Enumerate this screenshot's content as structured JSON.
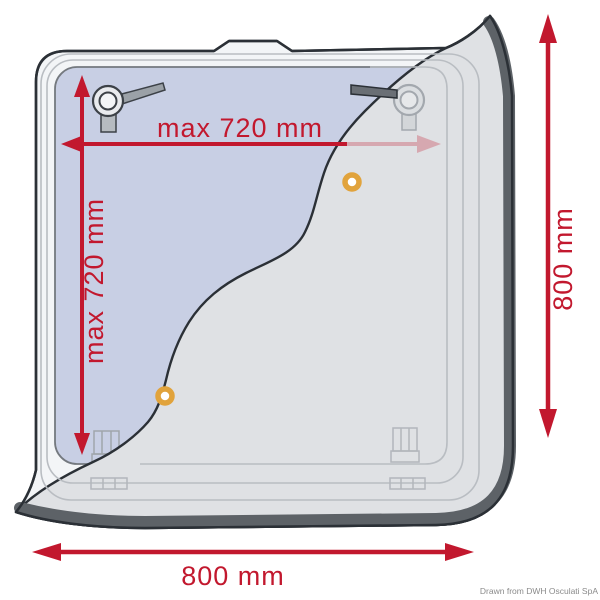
{
  "diagram": {
    "type": "technical-dimension-drawing",
    "subject": "deck hatch with roller shade, plan view with installation dimensions",
    "labels": {
      "opening_width": "max 720 mm",
      "opening_height": "max 720 mm",
      "overall_height": "800 mm",
      "overall_width": "800 mm"
    },
    "credit": "Drawn from DWH Osculati SpA",
    "colors": {
      "dimension_red": "#c2182e",
      "dimension_red_faded_opacity": "0.28",
      "opening_blue": "#c8cfe4",
      "shade_gray": "#dfe1e4",
      "frame_white": "#f3f5f7",
      "frame_edge_dark": "#5d6267",
      "outline_dark": "#2b3036",
      "faint_line_gray": "#b9bdc2",
      "grommet_orange": "#e1a33c",
      "credit_gray": "#8b8b8b"
    }
  }
}
